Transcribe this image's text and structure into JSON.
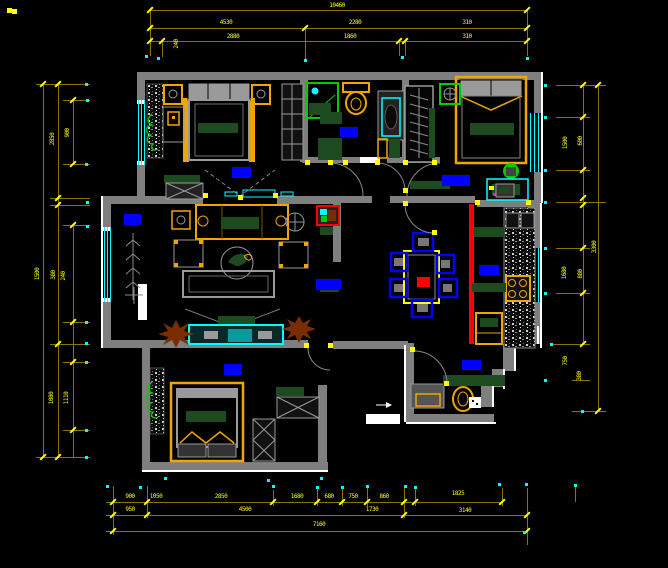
{
  "meta": {
    "type": "cad-floor-plan-screenshot",
    "drawing": "apartment plan with dimension chains"
  },
  "palette": {
    "bg": "#000000",
    "wall": "#7f7f7f",
    "wall2": "#9a9a9a",
    "whitec": "#ffffff",
    "dimline": "#8a7400",
    "tick": "#ffff00",
    "cyan": "#00ffff",
    "blue": "#0000ff",
    "orange": "#f0a500",
    "dkgreen": "#1d4a1e",
    "green": "#00cc00",
    "red": "#ff0000",
    "brown": "#7a2d00",
    "magenta": "#ff00ff"
  },
  "dims": {
    "lines": [
      [
        150,
        10,
        527,
        10
      ],
      [
        150,
        28,
        527,
        28
      ],
      [
        150,
        41,
        527,
        41
      ],
      [
        43,
        84,
        43,
        457
      ],
      [
        58,
        84,
        58,
        457
      ],
      [
        73,
        100,
        73,
        164
      ],
      [
        73,
        225,
        73,
        457
      ],
      [
        583,
        85,
        583,
        344
      ],
      [
        598,
        85,
        598,
        411
      ],
      [
        106,
        502,
        502,
        502
      ],
      [
        106,
        515,
        527,
        515
      ],
      [
        106,
        531,
        527,
        531
      ],
      [
        150,
        10,
        150,
        56
      ],
      [
        162,
        41,
        162,
        57
      ],
      [
        305,
        28,
        305,
        59
      ],
      [
        399,
        41,
        399,
        56
      ],
      [
        405,
        41,
        405,
        56
      ],
      [
        527,
        10,
        527,
        56
      ],
      [
        36,
        84,
        90,
        84
      ],
      [
        63,
        100,
        90,
        100
      ],
      [
        63,
        164,
        90,
        164
      ],
      [
        50,
        198,
        90,
        198
      ],
      [
        50,
        205,
        90,
        205
      ],
      [
        63,
        225,
        90,
        225
      ],
      [
        63,
        322,
        90,
        322
      ],
      [
        50,
        344,
        90,
        344
      ],
      [
        63,
        362,
        90,
        362
      ],
      [
        63,
        430,
        90,
        430
      ],
      [
        36,
        457,
        90,
        457
      ],
      [
        556,
        85,
        606,
        85
      ],
      [
        556,
        117,
        590,
        117
      ],
      [
        556,
        170,
        590,
        170
      ],
      [
        556,
        202,
        606,
        202
      ],
      [
        556,
        248,
        590,
        248
      ],
      [
        556,
        293,
        590,
        293
      ],
      [
        550,
        344,
        590,
        344
      ],
      [
        572,
        380,
        590,
        380
      ],
      [
        572,
        411,
        606,
        411
      ],
      [
        113,
        486,
        113,
        535
      ],
      [
        147,
        486,
        147,
        518
      ],
      [
        273,
        490,
        273,
        506
      ],
      [
        317,
        487,
        317,
        506
      ],
      [
        342,
        487,
        342,
        506
      ],
      [
        367,
        487,
        367,
        506
      ],
      [
        404,
        486,
        404,
        518
      ],
      [
        415,
        487,
        415,
        506
      ],
      [
        502,
        488,
        502,
        506
      ],
      [
        527,
        488,
        527,
        545
      ],
      [
        575,
        484,
        575,
        502
      ]
    ],
    "ticks": [
      [
        150,
        10
      ],
      [
        527,
        10
      ],
      [
        150,
        28
      ],
      [
        305,
        28
      ],
      [
        527,
        28
      ],
      [
        150,
        41
      ],
      [
        162,
        41
      ],
      [
        399,
        41
      ],
      [
        405,
        41
      ],
      [
        527,
        41
      ],
      [
        43,
        84
      ],
      [
        58,
        84
      ],
      [
        73,
        100
      ],
      [
        73,
        164
      ],
      [
        58,
        198
      ],
      [
        58,
        205
      ],
      [
        73,
        225
      ],
      [
        73,
        322
      ],
      [
        58,
        344
      ],
      [
        73,
        362
      ],
      [
        73,
        430
      ],
      [
        43,
        457
      ],
      [
        58,
        457
      ],
      [
        583,
        85
      ],
      [
        598,
        85
      ],
      [
        583,
        117
      ],
      [
        583,
        170
      ],
      [
        583,
        198
      ],
      [
        583,
        205
      ],
      [
        583,
        248
      ],
      [
        583,
        293
      ],
      [
        583,
        344
      ],
      [
        598,
        411
      ],
      [
        113,
        502
      ],
      [
        147,
        502
      ],
      [
        273,
        502
      ],
      [
        317,
        502
      ],
      [
        342,
        502
      ],
      [
        367,
        502
      ],
      [
        404,
        502
      ],
      [
        415,
        502
      ],
      [
        502,
        502
      ],
      [
        113,
        515
      ],
      [
        147,
        515
      ],
      [
        404,
        515
      ],
      [
        527,
        515
      ],
      [
        113,
        531
      ],
      [
        527,
        531
      ]
    ],
    "cyan_dots": [
      [
        146,
        56
      ],
      [
        158,
        58
      ],
      [
        305,
        60
      ],
      [
        402,
        57
      ],
      [
        527,
        58
      ],
      [
        86,
        84
      ],
      [
        87,
        100
      ],
      [
        86,
        164
      ],
      [
        87,
        202
      ],
      [
        87,
        226
      ],
      [
        86,
        322
      ],
      [
        86,
        343
      ],
      [
        86,
        362
      ],
      [
        86,
        430
      ],
      [
        86,
        457
      ],
      [
        545,
        85
      ],
      [
        545,
        117
      ],
      [
        545,
        170
      ],
      [
        545,
        202
      ],
      [
        545,
        248
      ],
      [
        545,
        293
      ],
      [
        551,
        344
      ],
      [
        545,
        380
      ],
      [
        582,
        411
      ],
      [
        107,
        486
      ],
      [
        140,
        487
      ],
      [
        273,
        486
      ],
      [
        317,
        487
      ],
      [
        342,
        487
      ],
      [
        367,
        486
      ],
      [
        405,
        486
      ],
      [
        415,
        487
      ],
      [
        499,
        484
      ],
      [
        526,
        484
      ],
      [
        524,
        532
      ],
      [
        575,
        485
      ],
      [
        165,
        478
      ],
      [
        268,
        480
      ],
      [
        321,
        478
      ]
    ],
    "texts": [
      {
        "t": "10460",
        "x": 337,
        "y": 6
      },
      {
        "t": "4530",
        "x": 226,
        "y": 23
      },
      {
        "t": "2280",
        "x": 355,
        "y": 23
      },
      {
        "t": "310",
        "x": 467,
        "y": 23
      },
      {
        "t": "2880",
        "x": 233,
        "y": 37
      },
      {
        "t": "1860",
        "x": 350,
        "y": 37
      },
      {
        "t": "310",
        "x": 467,
        "y": 37
      },
      {
        "t": "240",
        "x": 177,
        "y": 44,
        "r": -90
      },
      {
        "t": "2850",
        "x": 53,
        "y": 139,
        "r": -90
      },
      {
        "t": "900",
        "x": 68,
        "y": 133,
        "r": -90
      },
      {
        "t": "1500",
        "x": 38,
        "y": 274,
        "r": -90
      },
      {
        "t": "380",
        "x": 54,
        "y": 275,
        "r": -90
      },
      {
        "t": "240",
        "x": 64,
        "y": 276,
        "r": -90
      },
      {
        "t": "1080",
        "x": 52,
        "y": 398,
        "r": -90
      },
      {
        "t": "1110",
        "x": 67,
        "y": 398,
        "r": -90
      },
      {
        "t": "1500",
        "x": 566,
        "y": 143,
        "r": -90
      },
      {
        "t": "600",
        "x": 581,
        "y": 141,
        "r": -90
      },
      {
        "t": "3300",
        "x": 595,
        "y": 247,
        "r": -90
      },
      {
        "t": "1680",
        "x": 565,
        "y": 273,
        "r": -90
      },
      {
        "t": "880",
        "x": 581,
        "y": 274,
        "r": -90
      },
      {
        "t": "750",
        "x": 566,
        "y": 361,
        "r": -90
      },
      {
        "t": "380",
        "x": 580,
        "y": 376,
        "r": -90
      },
      {
        "t": "900",
        "x": 130,
        "y": 497
      },
      {
        "t": "1050",
        "x": 156,
        "y": 497
      },
      {
        "t": "2850",
        "x": 221,
        "y": 497
      },
      {
        "t": "1680",
        "x": 297,
        "y": 497
      },
      {
        "t": "680",
        "x": 329,
        "y": 497
      },
      {
        "t": "750",
        "x": 353,
        "y": 497
      },
      {
        "t": "860",
        "x": 384,
        "y": 497
      },
      {
        "t": "1825",
        "x": 458,
        "y": 494
      },
      {
        "t": "950",
        "x": 130,
        "y": 510
      },
      {
        "t": "4500",
        "x": 245,
        "y": 510
      },
      {
        "t": "1730",
        "x": 372,
        "y": 510
      },
      {
        "t": "3140",
        "x": 465,
        "y": 511
      },
      {
        "t": "7160",
        "x": 319,
        "y": 525
      }
    ]
  },
  "plan": {
    "room_labels": [
      {
        "room": "bedroom-1",
        "x": 232,
        "y": 167,
        "w": 19,
        "h": 11
      },
      {
        "room": "bathroom",
        "x": 340,
        "y": 127,
        "w": 18,
        "h": 10
      },
      {
        "room": "bedroom-2",
        "x": 442,
        "y": 175,
        "w": 28,
        "h": 11
      },
      {
        "room": "living-room",
        "x": 316,
        "y": 279,
        "w": 25,
        "h": 11
      },
      {
        "room": "balcony-bay",
        "x": 124,
        "y": 214,
        "w": 17,
        "h": 11
      },
      {
        "room": "kitchen",
        "x": 479,
        "y": 265,
        "w": 20,
        "h": 10
      },
      {
        "room": "entry",
        "x": 462,
        "y": 360,
        "w": 19,
        "h": 10
      },
      {
        "room": "bedroom-3",
        "x": 224,
        "y": 364,
        "w": 18,
        "h": 11
      }
    ],
    "hinge_dots": [
      [
        205,
        195
      ],
      [
        275,
        195
      ],
      [
        240,
        197
      ],
      [
        307,
        162
      ],
      [
        330,
        162
      ],
      [
        345,
        162
      ],
      [
        377,
        162
      ],
      [
        405,
        162
      ],
      [
        405,
        190
      ],
      [
        434,
        162
      ],
      [
        405,
        203
      ],
      [
        434,
        232
      ],
      [
        306,
        345
      ],
      [
        330,
        345
      ],
      [
        412,
        349
      ],
      [
        446,
        383
      ],
      [
        477,
        202
      ],
      [
        528,
        202
      ],
      [
        9,
        10
      ],
      [
        14,
        11
      ]
    ]
  }
}
